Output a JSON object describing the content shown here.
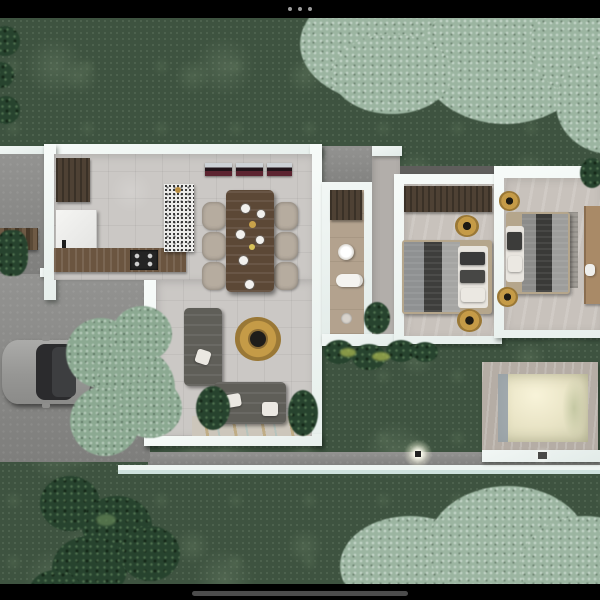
{
  "ui": {
    "top_bar": {
      "icon": "ellipsis-menu-icon",
      "background": "#000000",
      "dot_color": "#9d9d9d"
    },
    "bottom_bar": {
      "icon": "home-indicator",
      "background": "#000000",
      "indicator_color": "#4c4c4c"
    }
  },
  "scene": {
    "type": "architectural-floor-plan-render",
    "view": "top-down aerial 3D rendering",
    "rooms": {
      "kitchen": {
        "label": "Kitchen"
      },
      "dining": {
        "label": "Dining area"
      },
      "living": {
        "label": "Living room"
      },
      "bathroom": {
        "label": "Bathroom"
      },
      "hallway": {
        "label": "Hallway"
      },
      "bedroom1": {
        "label": "Bedroom 1"
      },
      "bedroom2": {
        "label": "Bedroom 2"
      },
      "carport": {
        "label": "Carport"
      },
      "court": {
        "label": "Side court"
      },
      "porch": {
        "label": "Entry porch"
      },
      "path": {
        "label": "Rear walkway"
      },
      "pool": {
        "label": "Pool"
      },
      "garden": {
        "label": "Garden"
      }
    },
    "furniture": [
      "kitchen island",
      "stove",
      "fridge",
      "media console",
      "dining table with six chairs",
      "L-shaped sofa set",
      "round gold coffee table",
      "round rattan floor lamps",
      "double bed x2",
      "wardrobe",
      "desk",
      "bathroom vanity",
      "round sink",
      "toilet",
      "parked car",
      "potted plants"
    ],
    "palette": {
      "grass": "#3e5340",
      "tree_canopy": "#9cb5a1",
      "dark_plants": "#27432e",
      "walls": "#f2f7f5",
      "tile_floor": "#cbc8c5",
      "bathroom_floor": "#b3a28e",
      "concrete": "#8a8a88",
      "wood_dark": "#4e4134",
      "gold": "#c59b47",
      "pool_water": "#eae5c7",
      "sofa_gray": "#5f5e58"
    }
  }
}
